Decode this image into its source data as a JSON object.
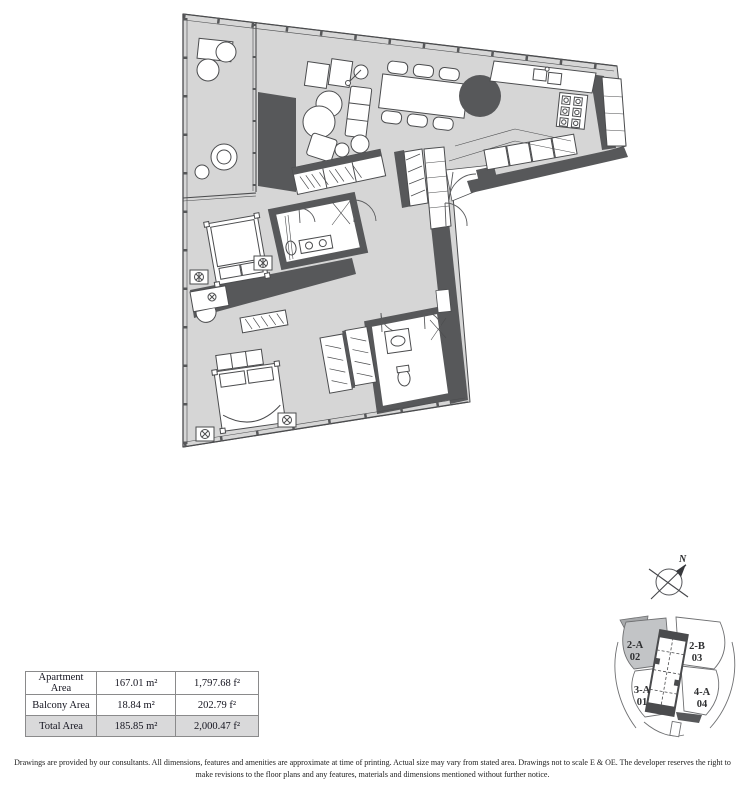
{
  "area_table": {
    "rows": [
      {
        "label": "Apartment Area",
        "metric": "167.01 m²",
        "imperial": "1,797.68 f²"
      },
      {
        "label": "Balcony Area",
        "metric": "18.84 m²",
        "imperial": "202.79 f²"
      },
      {
        "label": "Total Area",
        "metric": "185.85 m²",
        "imperial": "2,000.47 f²"
      }
    ]
  },
  "compass": {
    "north_label": "N"
  },
  "key_plan": {
    "units": [
      {
        "name": "2-A",
        "number": "02",
        "highlighted": true
      },
      {
        "name": "2-B",
        "number": "03",
        "highlighted": false
      },
      {
        "name": "3-A",
        "number": "01",
        "highlighted": false
      },
      {
        "name": "4-A",
        "number": "04",
        "highlighted": false
      }
    ]
  },
  "disclaimer": "Drawings are provided by our consultants. All dimensions, features and amenities are approximate at time of printing.  Actual size may vary from stated area. Drawings not to scale E & OE. The developer reserves the right to make revisions to the floor plans and any features, materials and dimensions mentioned without further notice.",
  "colors": {
    "floor": "#d6d6d6",
    "wall": "#57585a",
    "highlighted_unit": "#c2c4c6",
    "unit_balcony_wedge": "#a7a9ab",
    "total_row_bg": "#d9d9da"
  }
}
